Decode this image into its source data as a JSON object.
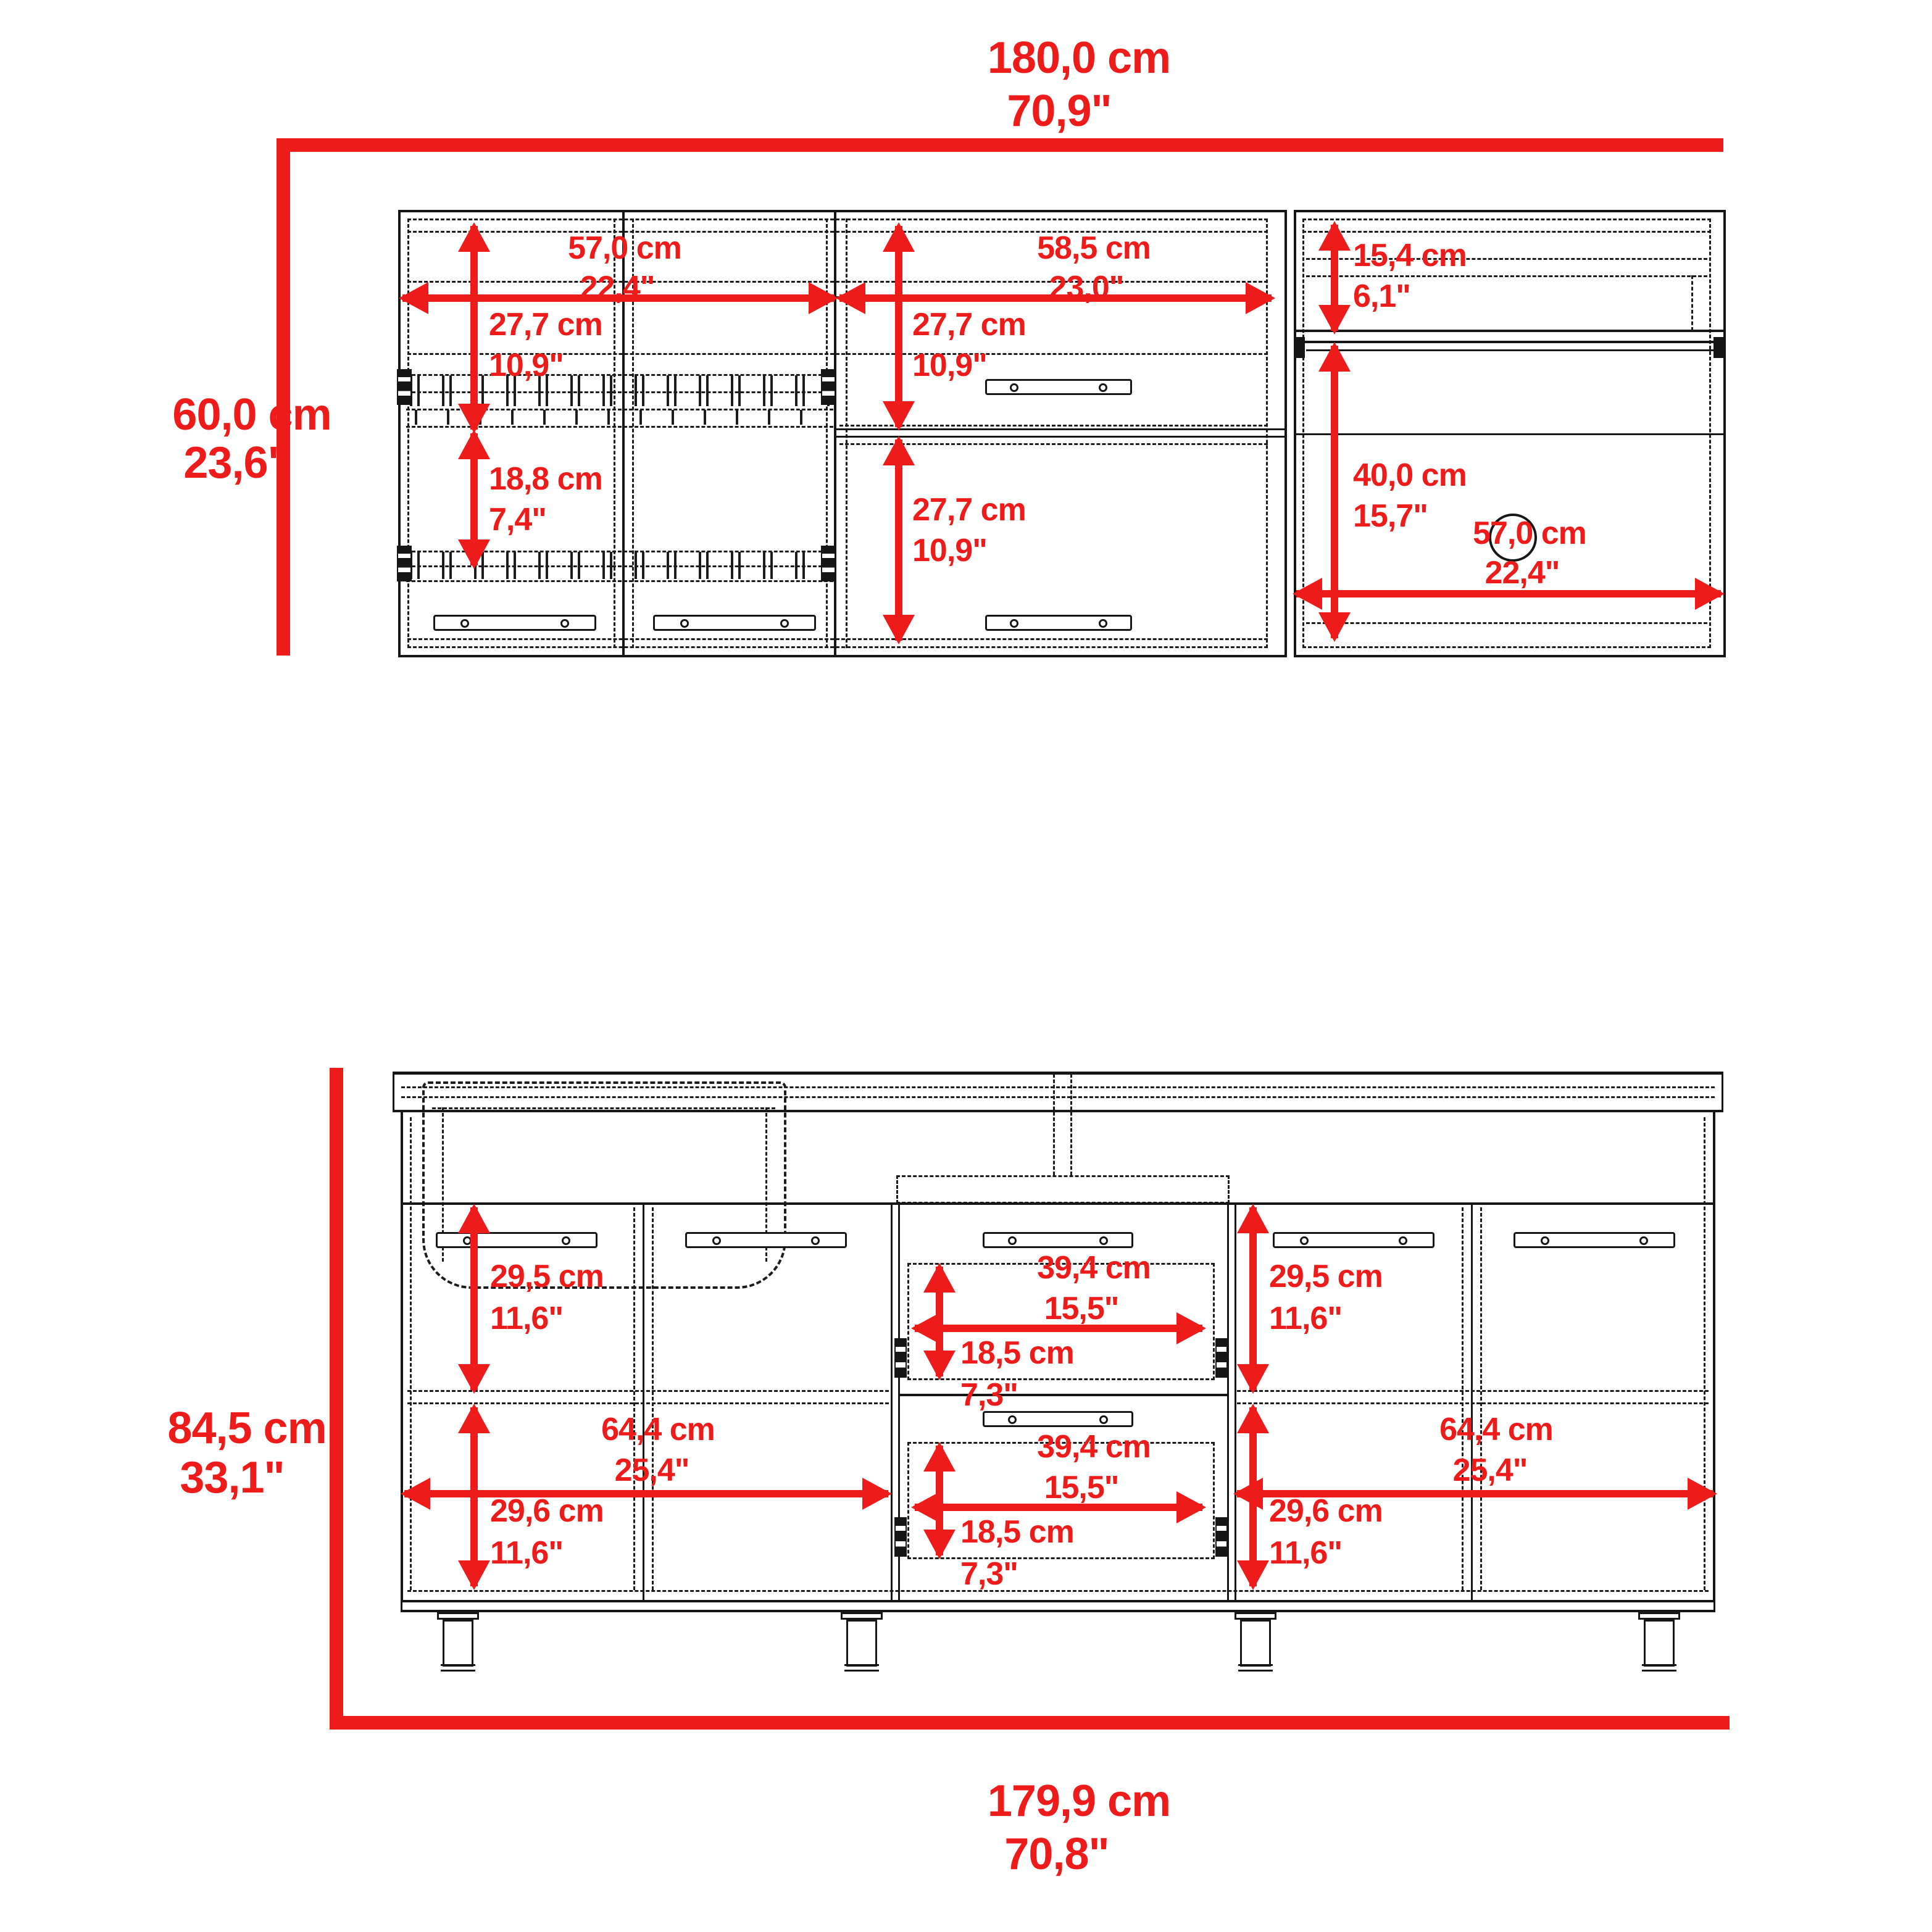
{
  "colors": {
    "dimension_red": "#ed1c1a",
    "line_black": "#161616"
  },
  "upper_cabinet": {
    "overall_width_cm": "180,0 cm",
    "overall_width_in": "70,9\"",
    "overall_height_cm": "60,0 cm",
    "overall_height_in": "23,6\"",
    "left_section_width_cm": "57,0 cm",
    "left_section_width_in": "22,4\"",
    "left_upper_height_cm": "27,7 cm",
    "left_upper_height_in": "10,9\"",
    "left_lower_height_cm": "18,8 cm",
    "left_lower_height_in": "7,4\"",
    "middle_section_width_cm": "58,5 cm",
    "middle_section_width_in": "23,0\"",
    "middle_top_door_height_cm": "27,7 cm",
    "middle_top_door_height_in": "10,9\"",
    "middle_bottom_door_height_cm": "27,7 cm",
    "middle_bottom_door_height_in": "10,9\"",
    "right_top_shelf_height_cm": "15,4 cm",
    "right_top_shelf_height_in": "6,1\"",
    "right_lower_height_cm": "40,0 cm",
    "right_lower_height_in": "15,7\"",
    "right_section_width_cm": "57,0 cm",
    "right_section_width_in": "22,4\""
  },
  "base_cabinet": {
    "overall_width_cm": "179,9 cm",
    "overall_width_in": "70,8\"",
    "overall_height_cm": "84,5 cm",
    "overall_height_in": "33,1\"",
    "left_upper_door_height_cm": "29,5 cm",
    "left_upper_door_height_in": "11,6\"",
    "left_lower_door_height_cm": "29,6 cm",
    "left_lower_door_height_in": "11,6\"",
    "left_section_width_cm": "64,4 cm",
    "left_section_width_in": "25,4\"",
    "right_upper_door_height_cm": "29,5 cm",
    "right_upper_door_height_in": "11,6\"",
    "right_lower_door_height_cm": "29,6 cm",
    "right_lower_door_height_in": "11,6\"",
    "right_section_width_cm": "64,4 cm",
    "right_section_width_in": "25,4\"",
    "top_drawer_width_cm": "39,4 cm",
    "top_drawer_width_in": "15,5\"",
    "top_drawer_height_cm": "18,5 cm",
    "top_drawer_height_in": "7,3\"",
    "bottom_drawer_width_cm": "39,4 cm",
    "bottom_drawer_width_in": "15,5\"",
    "bottom_drawer_height_cm": "18,5 cm",
    "bottom_drawer_height_in": "7,3\""
  }
}
